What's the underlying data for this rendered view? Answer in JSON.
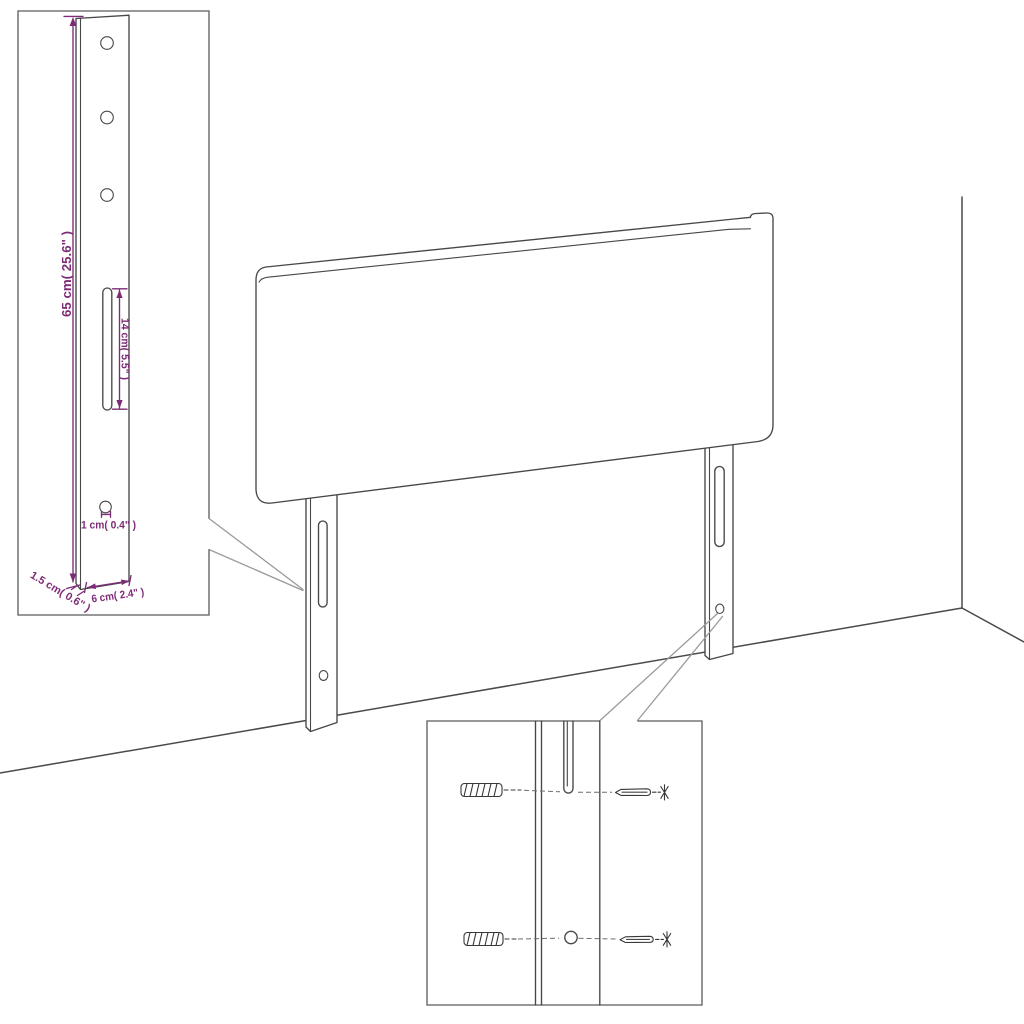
{
  "title": "Headboard assembly dimension diagram",
  "colors": {
    "background": "#ffffff",
    "drawing_line": "#474747",
    "callout_line": "#9a9a9a",
    "dimension_accent": "#7d2b76"
  },
  "dimensions": {
    "leg_height": "65 cm( 25.6\" )",
    "slot_length": "14 cm( 5.5\" )",
    "hole_size": "1 cm( 0.4\" )",
    "leg_thickness": "1.5 cm( 0.6\" )",
    "leg_width": "6 cm( 2.4\" )"
  },
  "icons": [
    "wall-plug-icon",
    "screw-icon"
  ],
  "parts": {
    "panel": "headboard-panel",
    "left_leg": "headboard-left-leg",
    "right_leg": "headboard-right-leg",
    "detail_insets": [
      "leg-dimension-detail",
      "wall-fixing-hardware-detail"
    ]
  }
}
